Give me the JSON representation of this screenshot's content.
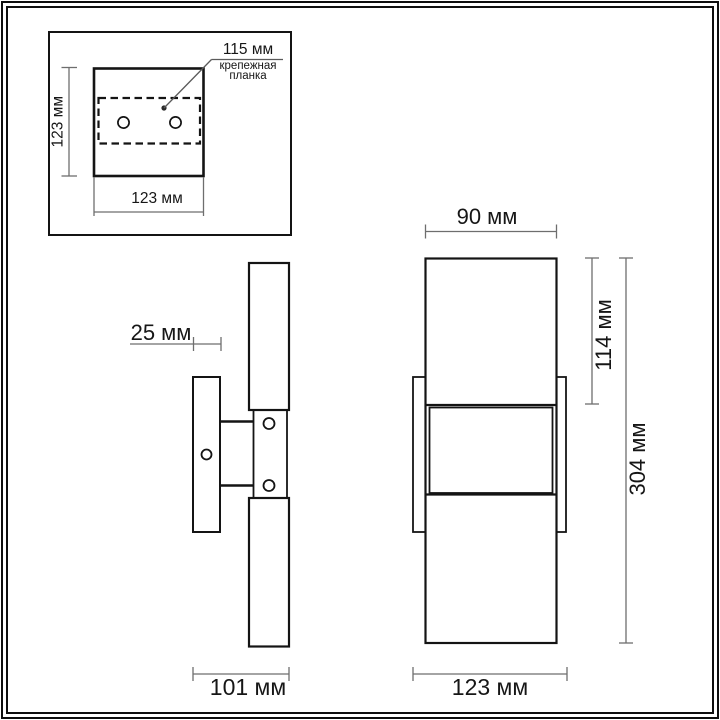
{
  "drawing": {
    "type": "wall-lamp dimensional drawing",
    "units": "мм",
    "colors": {
      "background": "#ffffff",
      "outline": "#141414",
      "dimension_line": "#6e6e6e",
      "text": "#161616"
    },
    "inset_panel": {
      "description": "top view of mounting plate",
      "height_dim_label": "123 мм",
      "width_dim_label": "123 мм",
      "callout": {
        "dim_label": "115 мм",
        "part_name_line1": "крепежная",
        "part_name_line2": "планка"
      }
    },
    "side_view": {
      "plate_depth_label": "25 мм",
      "total_depth_label": "101 мм"
    },
    "front_view": {
      "tube_width_label": "90 мм",
      "tube_height_label": "114 мм",
      "total_height_label": "304 мм",
      "base_width_label": "123 мм"
    }
  }
}
